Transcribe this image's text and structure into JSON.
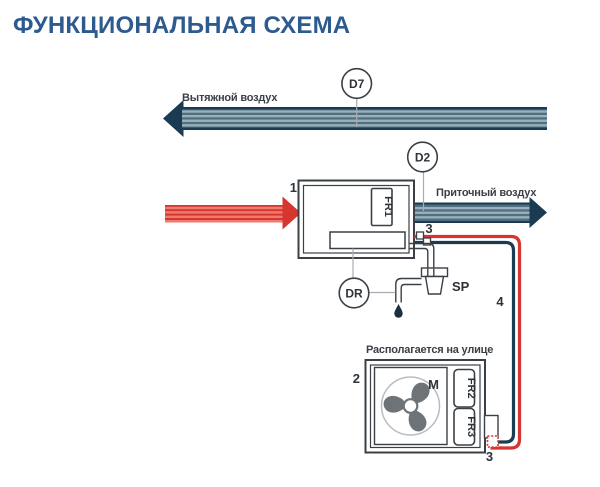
{
  "title": "ФУНКЦИОНАЛЬНАЯ СХЕМА",
  "colors": {
    "title_blue": "#2d5a8f",
    "duct_navy": "#1b3b52",
    "line_red": "#d5362f",
    "stripe_light_blue": "#9cb1bd",
    "stripe_dark_blue": "#50707f",
    "stripe_light_red": "#ee7b6e",
    "outline_dark": "#3b4046",
    "fan_gray": "#6e7377"
  },
  "labels": {
    "exhaust_air": "Вытяжной воздух",
    "supply_air": "Приточный воздух",
    "outdoor_note": "Располагается на улице"
  },
  "sensors": {
    "d7": "D7",
    "d2": "D2",
    "dr": "DR"
  },
  "components": {
    "indoor_unit_number": "1",
    "outdoor_unit_number": "2",
    "indoor_port_number": "3",
    "outdoor_port_number": "3",
    "line_number": "4",
    "fr1": "FR1",
    "fr2": "FR2",
    "fr3": "FR3",
    "motor": "M",
    "siphon": "SP"
  }
}
